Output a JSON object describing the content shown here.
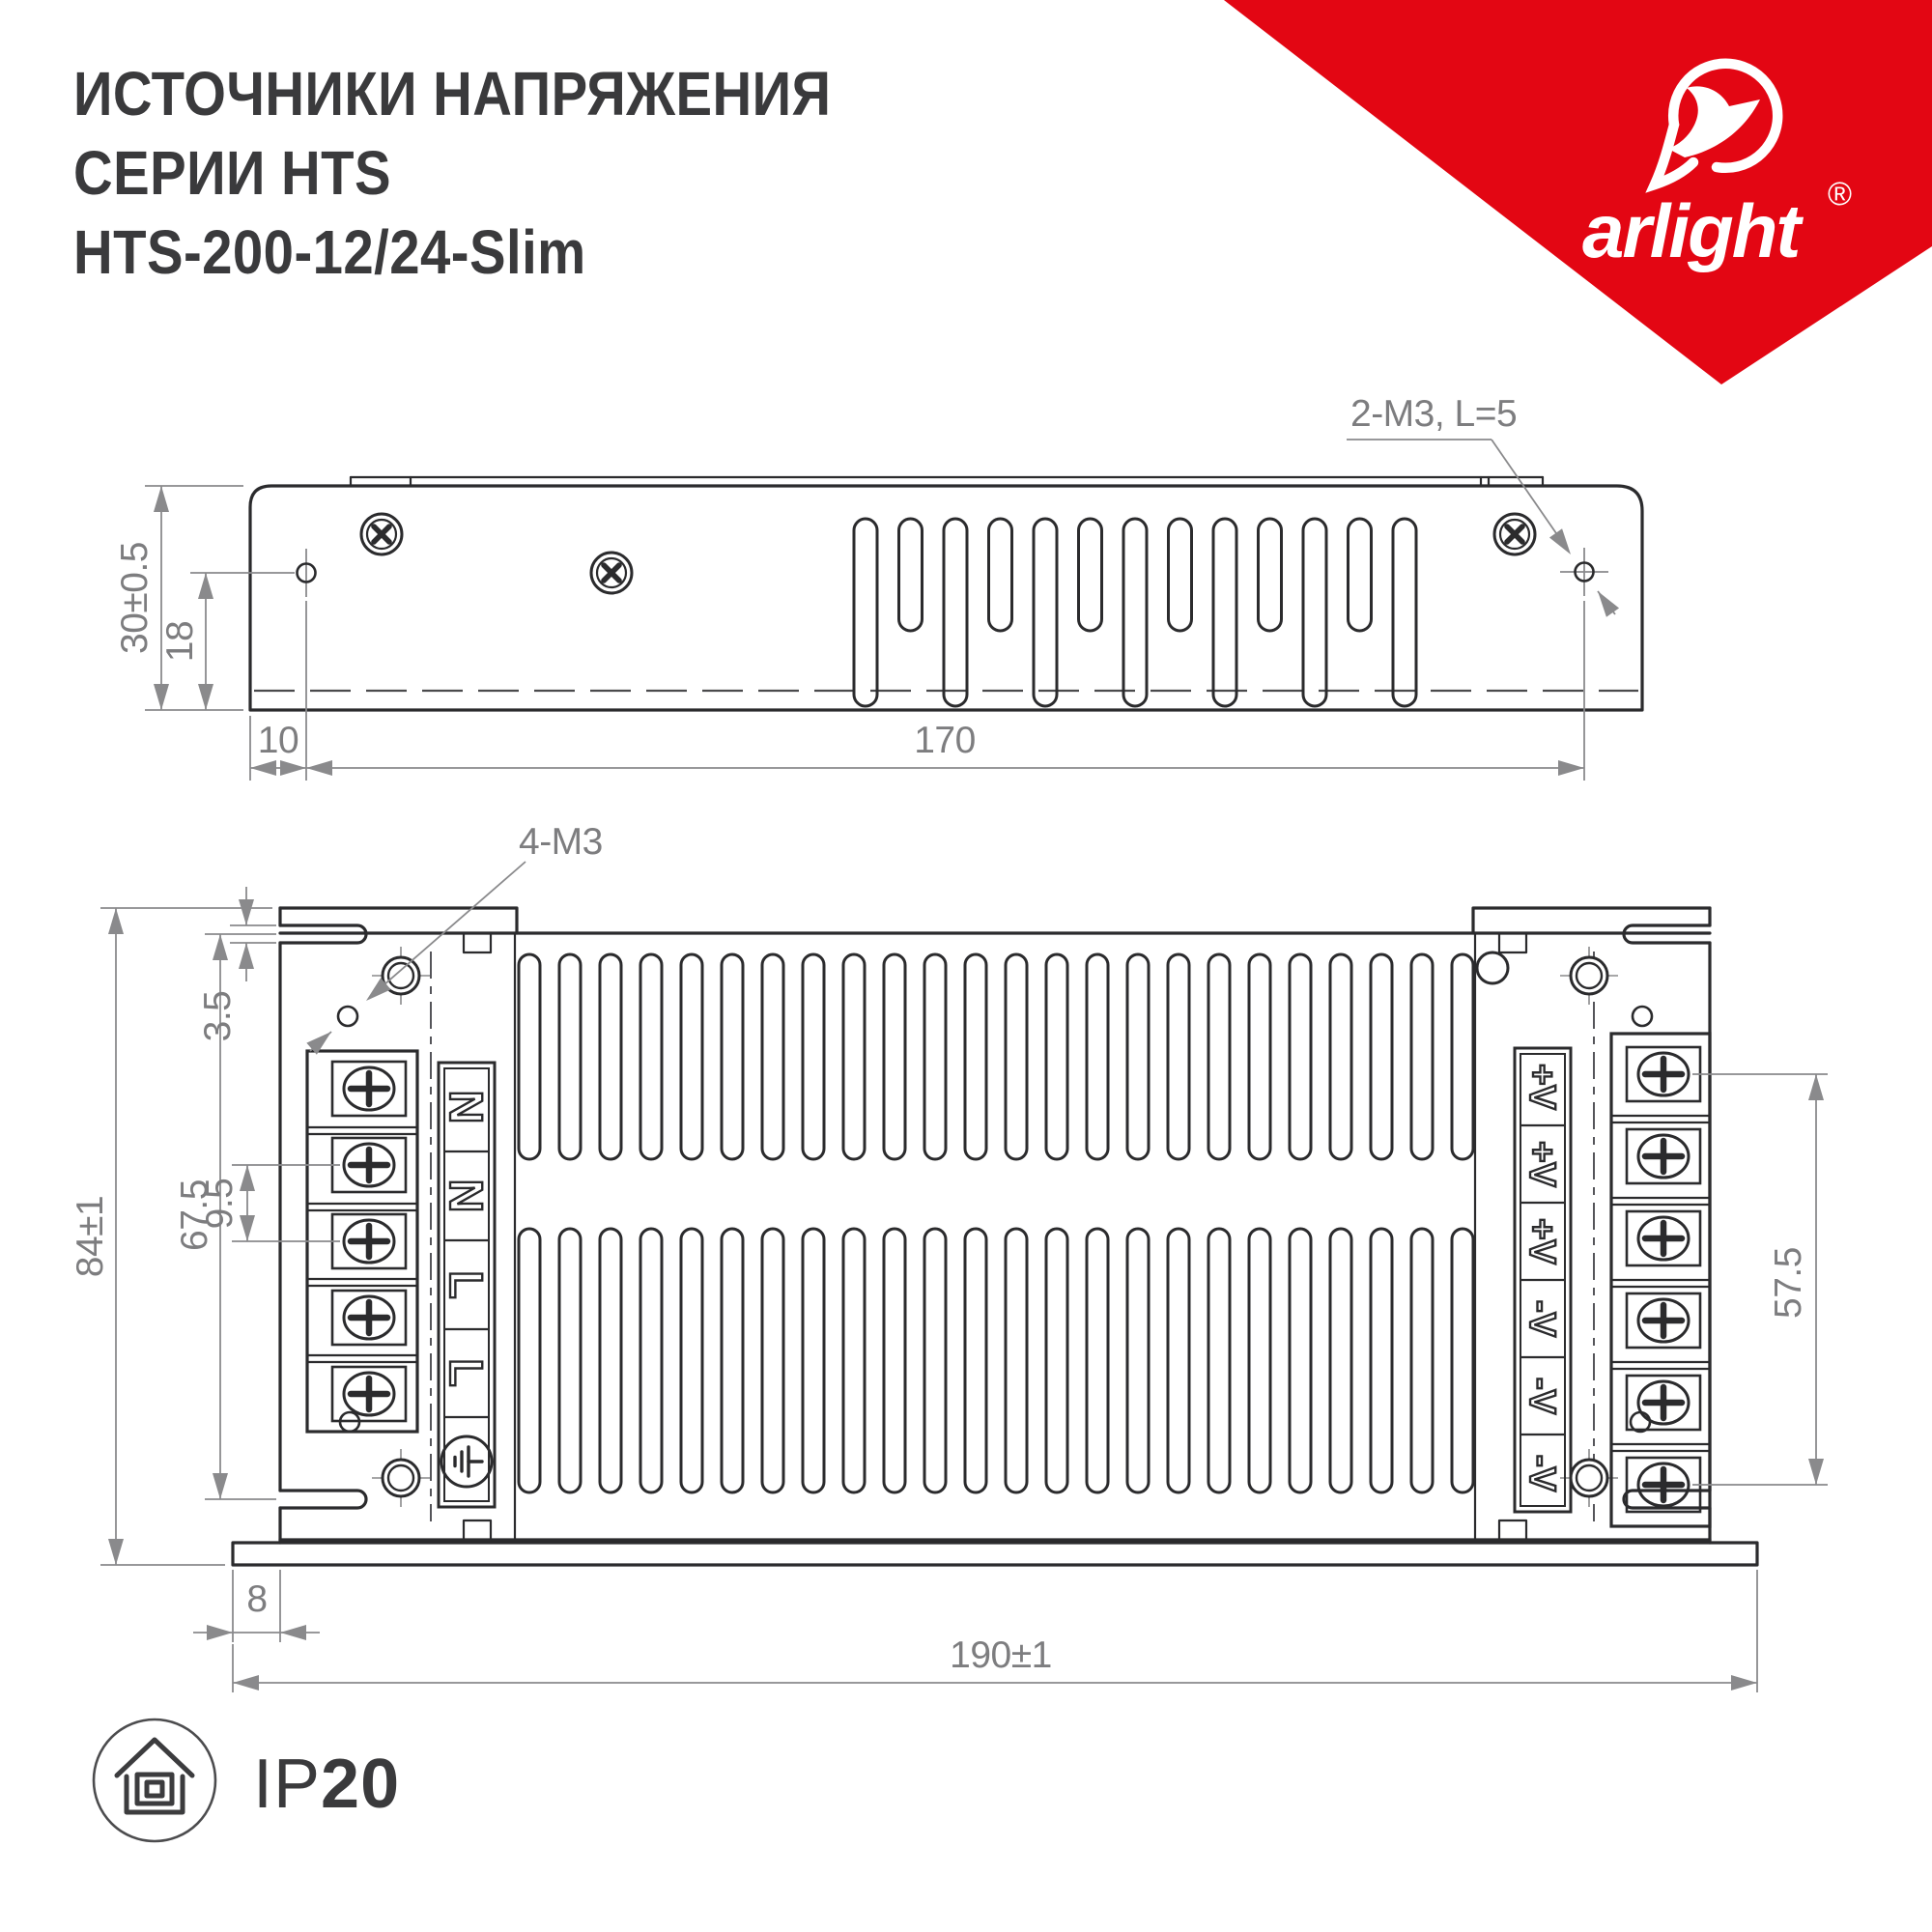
{
  "title": {
    "line1": "ИСТОЧНИКИ НАПРЯЖЕНИЯ",
    "line2": "СЕРИИ HTS",
    "line3": "HTS-200-12/24-Slim"
  },
  "brand": {
    "name": "arlight",
    "registered_mark": "®",
    "triangle_color": "#e30613"
  },
  "side_view": {
    "dimensions": {
      "height": "30±0.5",
      "hole_offset": "18",
      "left_margin": "10",
      "hole_spacing": "170",
      "screw_note": "2-M3, L=5"
    }
  },
  "bottom_view": {
    "dimensions": {
      "height": "84±1",
      "slot_span": "67.5",
      "slot_width": "3.5",
      "terminal_pitch": "9.5",
      "flange": "8",
      "length": "190±1",
      "output_span": "57.5",
      "screw_note": "4-M3"
    },
    "input_labels": [
      "N",
      "N",
      "L",
      "L"
    ],
    "output_labels": [
      "+V",
      "+V",
      "+V",
      "-V",
      "-V",
      "-V"
    ]
  },
  "badge": {
    "ip_prefix": "IP",
    "ip_value": "20"
  },
  "colors": {
    "line": "#2b2b2d",
    "dim": "#8a8a8c",
    "brand_red": "#e30613",
    "title": "#3a3a3c"
  }
}
